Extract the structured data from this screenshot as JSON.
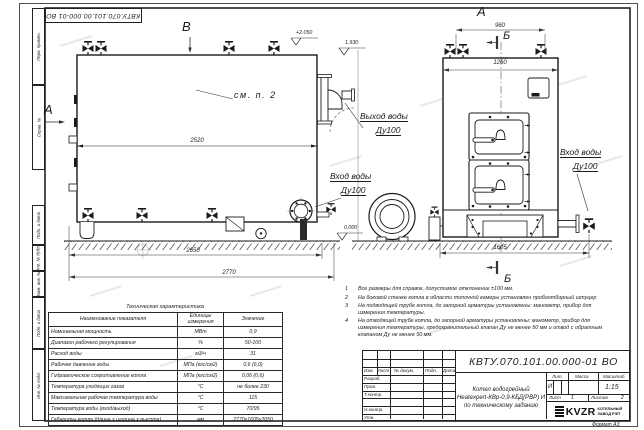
{
  "sheet": {
    "designation": "КВТУ.070.101.00.000-01 ВО",
    "format_label": "Формат А3",
    "margin_stamps": [
      "Перв. примен.",
      "Справ. №",
      "Подп. и дата",
      "Инв. № дубл.",
      "Взам. инв. №",
      "Подп. и дата",
      "Инв. № подл."
    ]
  },
  "views": {
    "label_a": "А",
    "label_b": "Б",
    "label_v": "В",
    "see_note": "см. п. 2",
    "dim_2520": "2520",
    "dim_2650": "2650",
    "dim_2770": "2770",
    "dim_960": "960",
    "dim_1260": "1260",
    "dim_1605": "1605",
    "elev_top": "+2.050",
    "elev_outlet": "1.930",
    "elev_ground": "0.000",
    "outlet_label_1": "Выход воды",
    "outlet_label_2": "Ду100",
    "inlet_left_label_1": "Вход воды",
    "inlet_left_label_2": "Ду100",
    "inlet_right_label_1": "Вход воды",
    "inlet_right_label_2": "Ду100"
  },
  "notes": {
    "items": [
      {
        "num": "1",
        "text": "Все размеры для справок, допустимое отклонение ±100 мм."
      },
      {
        "num": "2",
        "text": "На боковой стенке котла в области топочной камеры установлен пробоотборный штуцер"
      },
      {
        "num": "3",
        "text": "На подводящей трубе котла, до запорной арматуры установлены: манометр, прибор для измерения температуры."
      },
      {
        "num": "4",
        "text": "На отводящей трубе котла, до запорной арматуры установлены: манометр, прибор для измерения температуры, предохранительный клапан Ду не менее 50 мм и отвод с обратным клапаном Ду не менее 50 мм."
      }
    ]
  },
  "tech_table": {
    "title": "Техническая характеристика",
    "col_name": "Наименование показателя",
    "col_units": "Единицы измерения",
    "col_value": "Значение",
    "rows": [
      {
        "name": "Номинальная мощность",
        "units": "МВт",
        "value": "0,9"
      },
      {
        "name": "Диапазон рабочего регулирования",
        "units": "%",
        "value": "50-100"
      },
      {
        "name": "Расход воды",
        "units": "м3/ч",
        "value": "31"
      },
      {
        "name": "Рабочее давление воды",
        "units": "МПа (кгс/см2)",
        "value": "0,6 (6,0)"
      },
      {
        "name": "Гидравлическое сопротивление котла",
        "units": "МПа (кгс/см2)",
        "value": "0,06 (0,6)"
      },
      {
        "name": "Температура уходящих газов",
        "units": "°С",
        "value": "не более 230"
      },
      {
        "name": "Максимальная рабочая температура воды",
        "units": "°С",
        "value": "115"
      },
      {
        "name": "Температура воды (вход/выход)",
        "units": "°С",
        "value": "70/95"
      },
      {
        "name": "Габариты котла (длина х ширина х высота)",
        "units": "мм",
        "value": "2770х1605х2050"
      }
    ]
  },
  "title_block": {
    "designation": "КВТУ.070.101.00.000-01 ВО",
    "doc_name_1": "Котел водогрейный",
    "doc_name_2": "Heatexpert-КВр-0,9-КБД(РВР) И",
    "doc_name_3": "по техническому заданию",
    "col_izm": "Изм.",
    "col_list": "Лист",
    "col_doc": "№ докум.",
    "col_podp": "Подп.",
    "col_data": "Дата",
    "row_razrab": "Разраб.",
    "row_prov": "Пров.",
    "row_tkontr": "Т.контр.",
    "row_nkontr": "Н.контр.",
    "row_utv": "Утв.",
    "lit_label": "Лит.",
    "lit_value": "И",
    "mass_label": "Масса",
    "scale_label": "Масштаб",
    "scale_value": "1:15",
    "sheet_label": "Лист",
    "sheet_value": "1",
    "sheets_label": "Листов",
    "sheets_value": "2",
    "logo_text": "KVZR",
    "company_1": "КОТЕЛЬНЫЙ",
    "company_2": "ЗАВОД РЭП"
  }
}
